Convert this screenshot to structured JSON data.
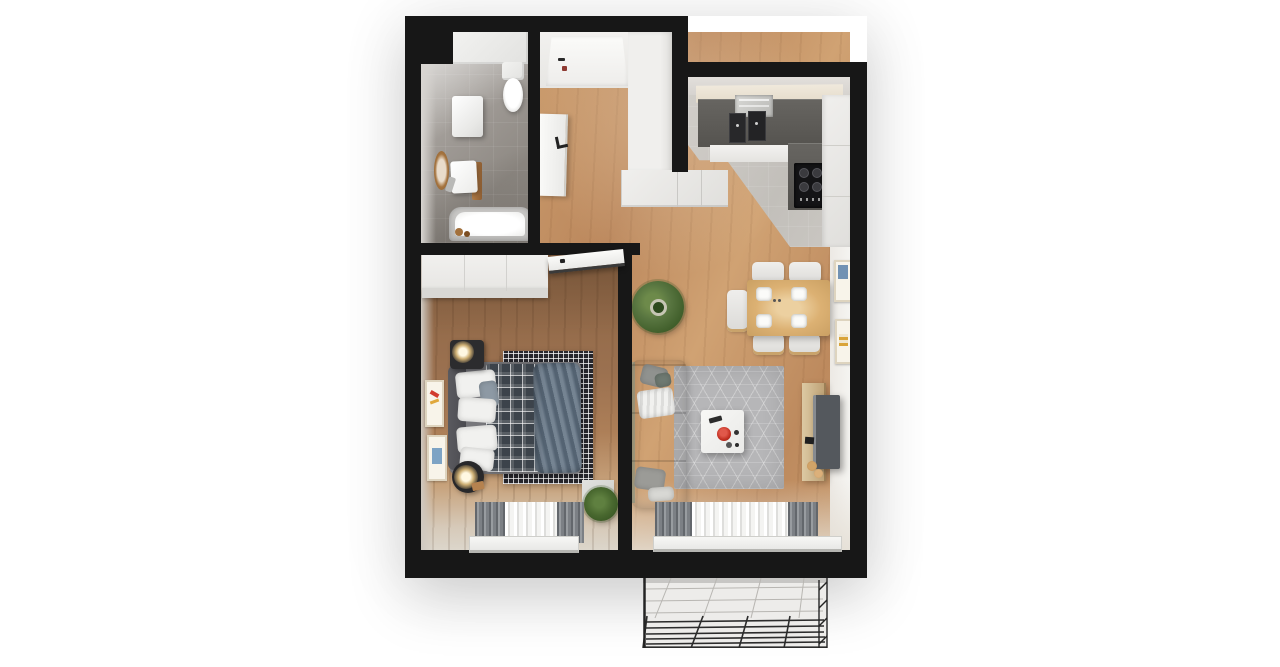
{
  "scene": {
    "type": "3d-apartment-floor-plan-top-view",
    "background": "#ffffff",
    "visible_text": []
  },
  "palette": {
    "wall": "#171717",
    "wood_living_hall": "#c2915f",
    "wood_bedroom": "#96704c",
    "bathroom_tile": "#96918b",
    "kitchen_tile": "#c7c4c0",
    "cabinet_white": "#ebebeb",
    "countertop_dark": "#5b5956",
    "sofa_taupe": "#b3aaa0",
    "living_rug_gray": "#b6b6b8",
    "bedroom_rug_check": "#26262c",
    "plaid_blanket": "#3c434b",
    "duvet_blue": "#5d6e7f",
    "dining_table_wood": "#dcb173",
    "accent_red_bowl": "#c23022",
    "plant_green": "#4e6e33",
    "curtain_gray": "#7c8085",
    "curtain_sheer": "#f4f4f2",
    "balcony_floor": "#edecea",
    "tv_gray": "#54585d",
    "lamp_glow": "#ffefc2"
  },
  "rooms": {
    "bathroom": {
      "items": [
        "toilet",
        "washing-machine",
        "washbasin",
        "round-mirror",
        "bathtub",
        "bath-accessories"
      ]
    },
    "hallway": {
      "items": [
        "entrance-door",
        "open-bathroom-door",
        "tall-wardrobe",
        "cabinet-row"
      ]
    },
    "kitchen": {
      "items": [
        "upper-counter",
        "sink-with-dishes",
        "two-black-appliances",
        "cooktop-4-burners",
        "right-cabinet-column"
      ]
    },
    "dining": {
      "items": [
        "wood-table",
        "four-plates",
        "five-chairs",
        "two-wall-frames"
      ]
    },
    "living": {
      "items": [
        "corner-sofa",
        "throw-blanket",
        "pillows",
        "hex-pattern-rug",
        "coffee-table",
        "red-bowl",
        "tv-sideboard",
        "tv",
        "large-potted-plant",
        "window-with-curtains"
      ]
    },
    "bedroom": {
      "items": [
        "wardrobe",
        "open-door",
        "double-bed",
        "plaid-blanket",
        "blue-duvet",
        "checked-rug",
        "two-nightstands",
        "two-lamps",
        "two-wall-frames",
        "potted-plant",
        "storage-box",
        "window-with-curtains"
      ]
    },
    "balcony": {
      "items": [
        "tiled-floor",
        "metal-railing"
      ]
    }
  },
  "windows": [
    {
      "room": "bedroom",
      "position": "bottom"
    },
    {
      "room": "living",
      "position": "bottom"
    }
  ]
}
